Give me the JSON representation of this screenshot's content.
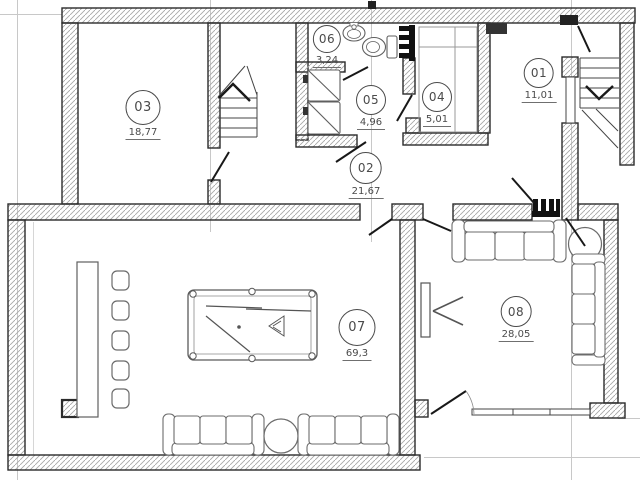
{
  "drawing": {
    "kind": "floor-plan",
    "colors": {
      "wall_line": "#2b2b2b",
      "hatch": "#a8a8a8",
      "gridline": "#c8c8c8",
      "furniture_line": "#6b6b6b",
      "label_text": "#4a4a4a"
    },
    "icons": [
      "staircase-up-icon",
      "staircase-down-icon",
      "sink-icon",
      "toilet-icon",
      "washing-machine-icon",
      "wardrobe-icon",
      "radiator-icon",
      "towel-rail-icon",
      "bar-counter-icon",
      "bar-stool-icon",
      "billiard-table-icon",
      "sofa-icon",
      "round-table-icon",
      "tv-icon",
      "door-leaf-icon",
      "window-icon"
    ]
  },
  "rooms": [
    {
      "id": "01",
      "area": "11,01"
    },
    {
      "id": "02",
      "area": "21,67"
    },
    {
      "id": "03",
      "area": "18,77"
    },
    {
      "id": "04",
      "area": "5,01"
    },
    {
      "id": "05",
      "area": "4,96"
    },
    {
      "id": "06",
      "area": "3,24"
    },
    {
      "id": "07",
      "area": "69,3"
    },
    {
      "id": "08",
      "area": "28,05"
    }
  ]
}
